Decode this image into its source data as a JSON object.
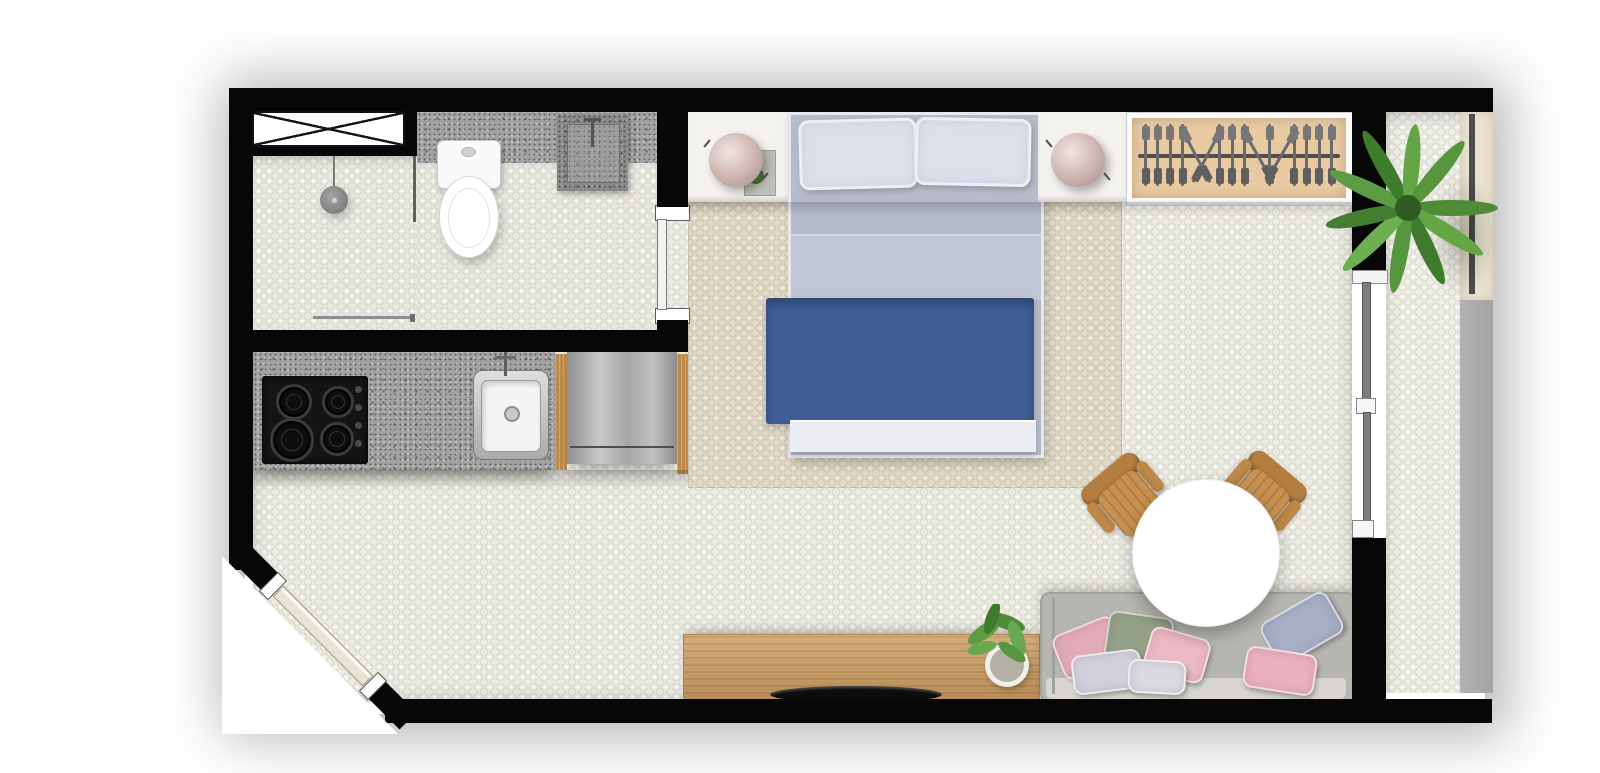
{
  "meta": {
    "type": "floor-plan",
    "view": "top-down-render",
    "unit": "studio-apartment",
    "visible_text": "none"
  },
  "palette": {
    "wall": "#070707",
    "floor_tile": "#edece4",
    "bathroom_tile": "#eae9e0",
    "rug": "#e0dbc9",
    "granite_counter": "#a2a2a2",
    "wood_trim": "#bd8c4c",
    "console_wood": "#cb9c60",
    "stainless_appliance": "#a8a8a8",
    "bed_sheet": "#b6bbcb",
    "bed_blanket_blue": "#3e5e95",
    "bed_pillow": "#dce0eb",
    "nightstand": "#f5f3ef",
    "lamp_mauve": "#cdb3b0",
    "wardrobe_interior": "#e9c9a2",
    "sofa_gray": "#b7b5b0",
    "dining_table": "#ffffff",
    "chair_wood": "#c79152",
    "plant_green": "#4e8c38",
    "balcony_ledge": "#e9e2cf",
    "balcony_outer_gray": "#a8a8a8",
    "entry_door_leaf": "#eae2d3",
    "glass_door_gray": "#7e7e7e"
  },
  "rooms": [
    {
      "id": "bathroom",
      "label": "bathroom",
      "fixtures": [
        "shower-head",
        "glass-partition",
        "sliding-door",
        "toilet",
        "stone-washbasin",
        "granite-vanity",
        "ventilation-shaft"
      ]
    },
    {
      "id": "kitchen",
      "label": "kitchenette",
      "fixtures": [
        "granite-countertop",
        "four-burner-cooktop",
        "inset-sink-with-faucet",
        "stainless-refrigerator",
        "wood-trim-panels"
      ]
    },
    {
      "id": "sleeping-area",
      "label": "sleeping-area",
      "fixtures": [
        "double-bed",
        "two-pillows",
        "blue-blanket",
        "left-nightstand",
        "right-nightstand",
        "two-sphere-lamps",
        "open-wardrobe-with-hangers",
        "area-rug"
      ]
    },
    {
      "id": "living-area",
      "label": "living-area",
      "fixtures": [
        "gray-sofa-with-pillows",
        "round-white-table",
        "two-wood-chairs",
        "tv-console",
        "flat-tv",
        "potted-plant"
      ]
    },
    {
      "id": "balcony",
      "label": "balcony",
      "fixtures": [
        "palm-plant",
        "ledge-with-railing",
        "two-panel-sliding-glass-door"
      ]
    },
    {
      "id": "entry",
      "label": "entry",
      "fixtures": [
        "diagonal-entrance-door"
      ]
    }
  ],
  "counts": {
    "wardrobe_hangers": 16,
    "cooktop_burners": 4,
    "cooktop_knobs": 4,
    "bed_pillows": 2,
    "sofa_pillows": 7,
    "dining_chairs": 2,
    "nightstand_lamps": 2
  },
  "bedroom": {
    "wardrobe": {
      "hanger_tilts": [
        0,
        0,
        0,
        0,
        -28,
        28,
        0,
        0,
        0,
        -30,
        0,
        30,
        0,
        0,
        0,
        0
      ]
    }
  },
  "living": {
    "sofa_pillows": [
      {
        "left": 14,
        "top": 30,
        "w": 62,
        "h": 44,
        "rot": -22,
        "color": "#e3aab9"
      },
      {
        "left": 64,
        "top": 20,
        "w": 62,
        "h": 46,
        "rot": 8,
        "color": "#95a186"
      },
      {
        "left": 30,
        "top": 58,
        "w": 66,
        "h": 36,
        "rot": -7,
        "color": "#d3d0dc"
      },
      {
        "left": 104,
        "top": 38,
        "w": 58,
        "h": 42,
        "rot": 16,
        "color": "#ecb8c6"
      },
      {
        "left": 86,
        "top": 66,
        "w": 54,
        "h": 30,
        "rot": 3,
        "color": "#dcd9e1"
      },
      {
        "left": 222,
        "top": 10,
        "w": 72,
        "h": 44,
        "rot": -30,
        "color": "#a7aec6"
      },
      {
        "left": 202,
        "top": 56,
        "w": 68,
        "h": 38,
        "rot": 9,
        "color": "#eab0bf"
      }
    ],
    "chairs": [
      {
        "left": 1090,
        "top": 462,
        "rot": -40
      },
      {
        "left": 1222,
        "top": 460,
        "rot": 40
      }
    ]
  }
}
